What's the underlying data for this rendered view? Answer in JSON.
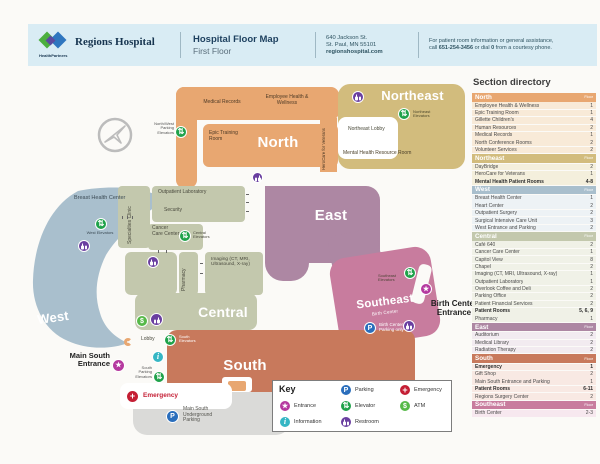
{
  "header": {
    "brand": "Regions Hospital",
    "brand_sub": "HealthPartners",
    "title": "Hospital Floor Map",
    "subtitle": "First Floor",
    "address_line1": "640 Jackson St.",
    "address_line2": "St. Paul, MN 55101",
    "address_line3": "regionshospital.com",
    "assist_line1": "For patient room information or general assistance,",
    "assist_pre": "call ",
    "assist_phone": "651-254-3456",
    "assist_mid": " or dial ",
    "assist_dial": "0",
    "assist_post": " from a courtesy phone."
  },
  "map": {
    "region_labels": {
      "north": "North",
      "northeast": "Northeast",
      "west": "West",
      "central": "Central",
      "east": "East",
      "south": "South",
      "southeast": "Southeast"
    },
    "labels": {
      "medical_records": "Medical Records",
      "employee_health": "Employee Health & Wellness",
      "epic_training": "Epic Training Room",
      "nw_parking_elevators": "North/West Parking Elevators",
      "northeast_elevators": "Northeast Elevators",
      "northeast_lobby": "Northeast Lobby",
      "herocare": "HeroCare for Veterans",
      "mental_health_resource": "Mental Health Resource Room",
      "breast_health": "Breast Health Center",
      "west_elevators": "West Elevators",
      "specialties_clinic": "Specialties Clinic",
      "outpatient_lab": "Outpatient Laboratory",
      "security": "Security",
      "cancer_care": "Cancer Care Center",
      "central_elevators": "Central Elevators",
      "pharmacy": "Pharmacy",
      "imaging": "Imaging (CT, MRI, Ultrasound, X-ray)",
      "southeast_elevators": "Southeast Elevators",
      "birth_center": "Birth Center",
      "birth_center_parking": "Birth Center Parking only",
      "birth_center_entrance": "Birth Center Entrance",
      "lobby": "Lobby",
      "south_elevators": "South Elevators",
      "south_parking_elevators": "South Parking Elevators",
      "emergency": "Emergency",
      "main_south_entrance": "Main South Entrance",
      "main_south_parking": "Main South Underground Parking"
    },
    "icon_glyphs": {
      "elevator": "⇅",
      "parking": "P",
      "information": "i",
      "emergency": "+",
      "atm": "$",
      "entrance": "★"
    }
  },
  "key": {
    "title": "Key",
    "items": [
      {
        "icon": "entrance-icon",
        "label": "Entrance"
      },
      {
        "icon": "information-icon",
        "label": "Information"
      },
      {
        "icon": "parking-icon",
        "label": "Parking"
      },
      {
        "icon": "elevator-icon",
        "label": "Elevator"
      },
      {
        "icon": "restroom-icon",
        "label": "Restroom"
      },
      {
        "icon": "emergency-icon",
        "label": "Emergency"
      },
      {
        "icon": "atm-icon",
        "label": "ATM"
      }
    ]
  },
  "colors": {
    "north": "#e8a771",
    "northeast": "#d2bc7d",
    "west": "#a9bfcd",
    "central": "#c3c8ad",
    "east": "#ad87a3",
    "south": "#c8795c",
    "southeast": "#c87c9e",
    "icon_entrance": "#b5399f",
    "icon_information": "#35b6c4",
    "icon_parking": "#2a6ebc",
    "icon_elevator": "#1fa24a",
    "icon_restroom": "#6a3fa0",
    "icon_emergency": "#c41e34",
    "icon_atm": "#56b948"
  },
  "directory": {
    "title": "Section directory",
    "floor_heading": "Floor",
    "sections": [
      {
        "name": "North",
        "color": "#e8a771",
        "row_bg": "#f8ead8",
        "rows": [
          {
            "name": "Employee Health & Wellness",
            "floor": "1"
          },
          {
            "name": "Epic Training Room",
            "floor": "1"
          },
          {
            "name": "Gillette Children's",
            "floor": "4"
          },
          {
            "name": "Human Resources",
            "floor": "2"
          },
          {
            "name": "Medical Records",
            "floor": "1"
          },
          {
            "name": "North Conference Rooms",
            "floor": "2"
          },
          {
            "name": "Volunteer Services",
            "floor": "2"
          }
        ]
      },
      {
        "name": "Northeast",
        "color": "#d2bc7d",
        "row_bg": "#f4efdc",
        "rows": [
          {
            "name": "DayBridge",
            "floor": "2"
          },
          {
            "name": "HeroCare for Veterans",
            "floor": "1"
          },
          {
            "name": "Mental Health Patient Rooms",
            "floor": "4-8",
            "bold": true
          }
        ]
      },
      {
        "name": "West",
        "color": "#a9bfcd",
        "row_bg": "#edf2f5",
        "rows": [
          {
            "name": "Breast Health Center",
            "floor": "1"
          },
          {
            "name": "Heart Center",
            "floor": "2"
          },
          {
            "name": "Outpatient Surgery",
            "floor": "2"
          },
          {
            "name": "Surgical Intensive Care Unit",
            "floor": "3"
          },
          {
            "name": "West Entrance and Parking",
            "floor": "2"
          }
        ]
      },
      {
        "name": "Central",
        "color": "#c3c8ad",
        "row_bg": "#f0f1e7",
        "rows": [
          {
            "name": "Café 640",
            "floor": "2"
          },
          {
            "name": "Cancer Care Center",
            "floor": "1"
          },
          {
            "name": "Capitol View",
            "floor": "8"
          },
          {
            "name": "Chapel",
            "floor": "2"
          },
          {
            "name": "Imaging (CT, MRI, Ultrasound, X-ray)",
            "floor": "1"
          },
          {
            "name": "Outpatient Laboratory",
            "floor": "1"
          },
          {
            "name": "Overlook Coffee and Deli",
            "floor": "2"
          },
          {
            "name": "Parking Office",
            "floor": "2"
          },
          {
            "name": "Patient Financial Services",
            "floor": "2"
          },
          {
            "name": "Patient Rooms",
            "floor": "5, 6, 9",
            "bold": true
          },
          {
            "name": "Pharmacy",
            "floor": "1"
          }
        ]
      },
      {
        "name": "East",
        "color": "#ad87a3",
        "row_bg": "#f2ebf0",
        "rows": [
          {
            "name": "Auditorium",
            "floor": "2"
          },
          {
            "name": "Medical Library",
            "floor": "2"
          },
          {
            "name": "Radiation Therapy",
            "floor": "2"
          }
        ]
      },
      {
        "name": "South",
        "color": "#c8795c",
        "row_bg": "#f8e9e3",
        "rows": [
          {
            "name": "Emergency",
            "floor": "1",
            "bold": true
          },
          {
            "name": "Gift Shop",
            "floor": "2"
          },
          {
            "name": "Main South Entrance and Parking",
            "floor": "1"
          },
          {
            "name": "Patient Rooms",
            "floor": "6-11",
            "bold": true
          },
          {
            "name": "Regions Surgery Center",
            "floor": "2"
          }
        ]
      },
      {
        "name": "Southeast",
        "color": "#c87c9e",
        "row_bg": "#f7e8ef",
        "rows": [
          {
            "name": "Birth Center",
            "floor": "2-3"
          }
        ]
      }
    ]
  }
}
